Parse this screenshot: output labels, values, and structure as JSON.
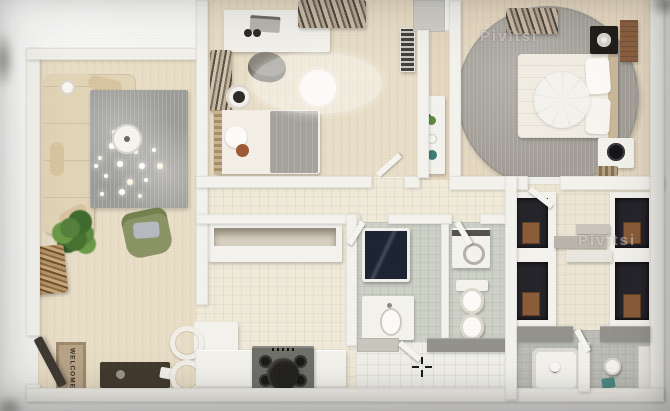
{
  "scene": {
    "kind": "3d-rendered top-down apartment floor plan photo",
    "cursor_marker": "crosshair",
    "rooms_depicted": [
      "living-room",
      "entrance-hall",
      "kids-bedroom",
      "master-bedroom",
      "kitchen-dining",
      "bathroom",
      "wc-laundry",
      "inner-hall",
      "dressing-room",
      "second-bathroom"
    ]
  },
  "texts": {
    "doormat": "WELCOME",
    "watermark_top": "Pivitsi",
    "watermark_right": "Pivitsi"
  },
  "palette": {
    "wood_floor": "#e9dec7",
    "tile_floor": "#f0ead9",
    "bath_tile": "#cdd1c6",
    "wall": "#f4f2ec",
    "gray_wall": "#93928c",
    "rug_gray": "#a19d96",
    "sofa_beige": "#e2d4b6",
    "armchair_green": "#8a9464",
    "closet_dark": "#26242b",
    "box_wood": "#8a5c38",
    "towel_teal": "#4c8a82",
    "pot_black": "#242320"
  }
}
